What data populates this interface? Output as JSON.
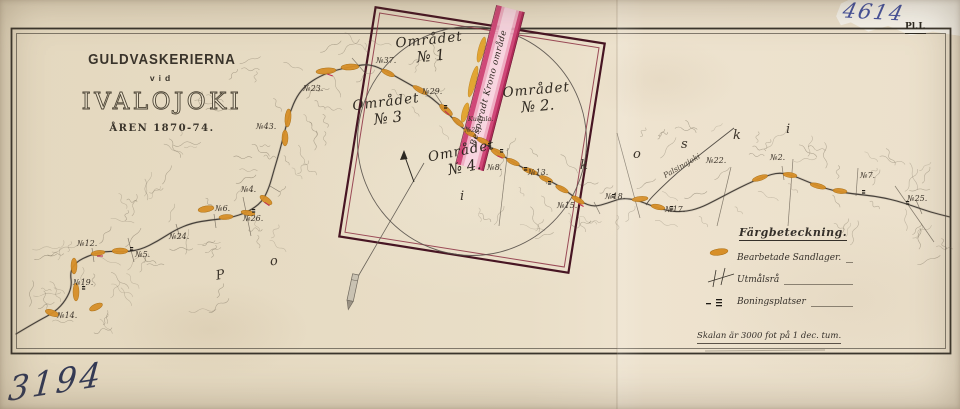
{
  "page": {
    "plate": "Pl.I.",
    "handwritten_top_right": "4614",
    "handwritten_bottom_left": "3194"
  },
  "title": {
    "line1": "GULDVASKERIERNA",
    "line2": "vid",
    "line3": "IVALOJOKI",
    "line4": "ÅREN 1870-74."
  },
  "inset": {
    "areas": [
      {
        "name": "Området",
        "no": "№ 1"
      },
      {
        "name": "Området",
        "no": "№ 2."
      },
      {
        "name": "Området",
        "no": "№ 3"
      },
      {
        "name": "Området",
        "no": "№ 4."
      }
    ],
    "stripe_label": "Besparadt Krono område"
  },
  "map": {
    "river_name_spaced": "P o r t t i k o s k i",
    "tributary_label": "Palsinajoki",
    "claim_labels": [
      {
        "text": "№23.",
        "x": 303,
        "y": 84
      },
      {
        "text": "№37.",
        "x": 376,
        "y": 56
      },
      {
        "text": "№29.",
        "x": 422,
        "y": 87
      },
      {
        "text": "№43.",
        "x": 256,
        "y": 122
      },
      {
        "text": "Kultala.",
        "x": 468,
        "y": 115,
        "small": true
      },
      {
        "text": "№28.",
        "x": 465,
        "y": 126,
        "small": true
      },
      {
        "text": "№8.",
        "x": 487,
        "y": 163
      },
      {
        "text": "№13.",
        "x": 528,
        "y": 168
      },
      {
        "text": "№15.",
        "x": 557,
        "y": 201
      },
      {
        "text": "№18.",
        "x": 605,
        "y": 192
      },
      {
        "text": "№17.",
        "x": 665,
        "y": 205
      },
      {
        "text": "№22.",
        "x": 706,
        "y": 156
      },
      {
        "text": "№2.",
        "x": 770,
        "y": 153
      },
      {
        "text": "№7.",
        "x": 860,
        "y": 171
      },
      {
        "text": "№25.",
        "x": 907,
        "y": 194
      },
      {
        "text": "№4.",
        "x": 241,
        "y": 185
      },
      {
        "text": "№6.",
        "x": 215,
        "y": 204
      },
      {
        "text": "№26.",
        "x": 243,
        "y": 214
      },
      {
        "text": "№24.",
        "x": 169,
        "y": 232
      },
      {
        "text": "№12.",
        "x": 77,
        "y": 239
      },
      {
        "text": "№5.",
        "x": 135,
        "y": 250
      },
      {
        "text": "№19.",
        "x": 73,
        "y": 278
      },
      {
        "text": "№14.",
        "x": 57,
        "y": 311
      }
    ],
    "river_letters": [
      {
        "ch": "P",
        "x": 216,
        "y": 268,
        "rot": -10
      },
      {
        "ch": "o",
        "x": 270,
        "y": 254,
        "rot": -8
      },
      {
        "ch": "i",
        "x": 460,
        "y": 189,
        "rot": 0
      },
      {
        "ch": "k",
        "x": 580,
        "y": 158,
        "rot": 0
      },
      {
        "ch": "o",
        "x": 633,
        "y": 147,
        "rot": 0
      },
      {
        "ch": "s",
        "x": 681,
        "y": 137,
        "rot": 0
      },
      {
        "ch": "k",
        "x": 733,
        "y": 128,
        "rot": 0
      },
      {
        "ch": "i",
        "x": 786,
        "y": 122,
        "rot": 0
      }
    ]
  },
  "legend": {
    "heading": "Färgbeteckning.",
    "items": [
      {
        "symbol": "sand-patch",
        "label": "Bearbetade Sandlager."
      },
      {
        "symbol": "claim-boundary",
        "label": "Utmålsrå"
      },
      {
        "symbol": "dwelling-marks",
        "label": "Boningsplatser"
      }
    ]
  },
  "scale": {
    "text": "Skalan är 3000 fot på 1 dec. tum."
  },
  "colors": {
    "paper": "#e9dec7",
    "ink": "#3b342a",
    "frame": "#3a352c",
    "river": "#46403a",
    "sand": "#d78f28",
    "sand_edge": "#a96d12",
    "square": "#471523",
    "square_inner": "#8c2f42",
    "stripe_pink": "#f0a9c2",
    "stripe_red": "#cf4878",
    "stripe_dark": "#b02a58",
    "hatch": "#6e6452",
    "red_mark": "#c03052",
    "hand_ink_blue": "#44519f",
    "hand_ink_dark": "#343a55"
  }
}
